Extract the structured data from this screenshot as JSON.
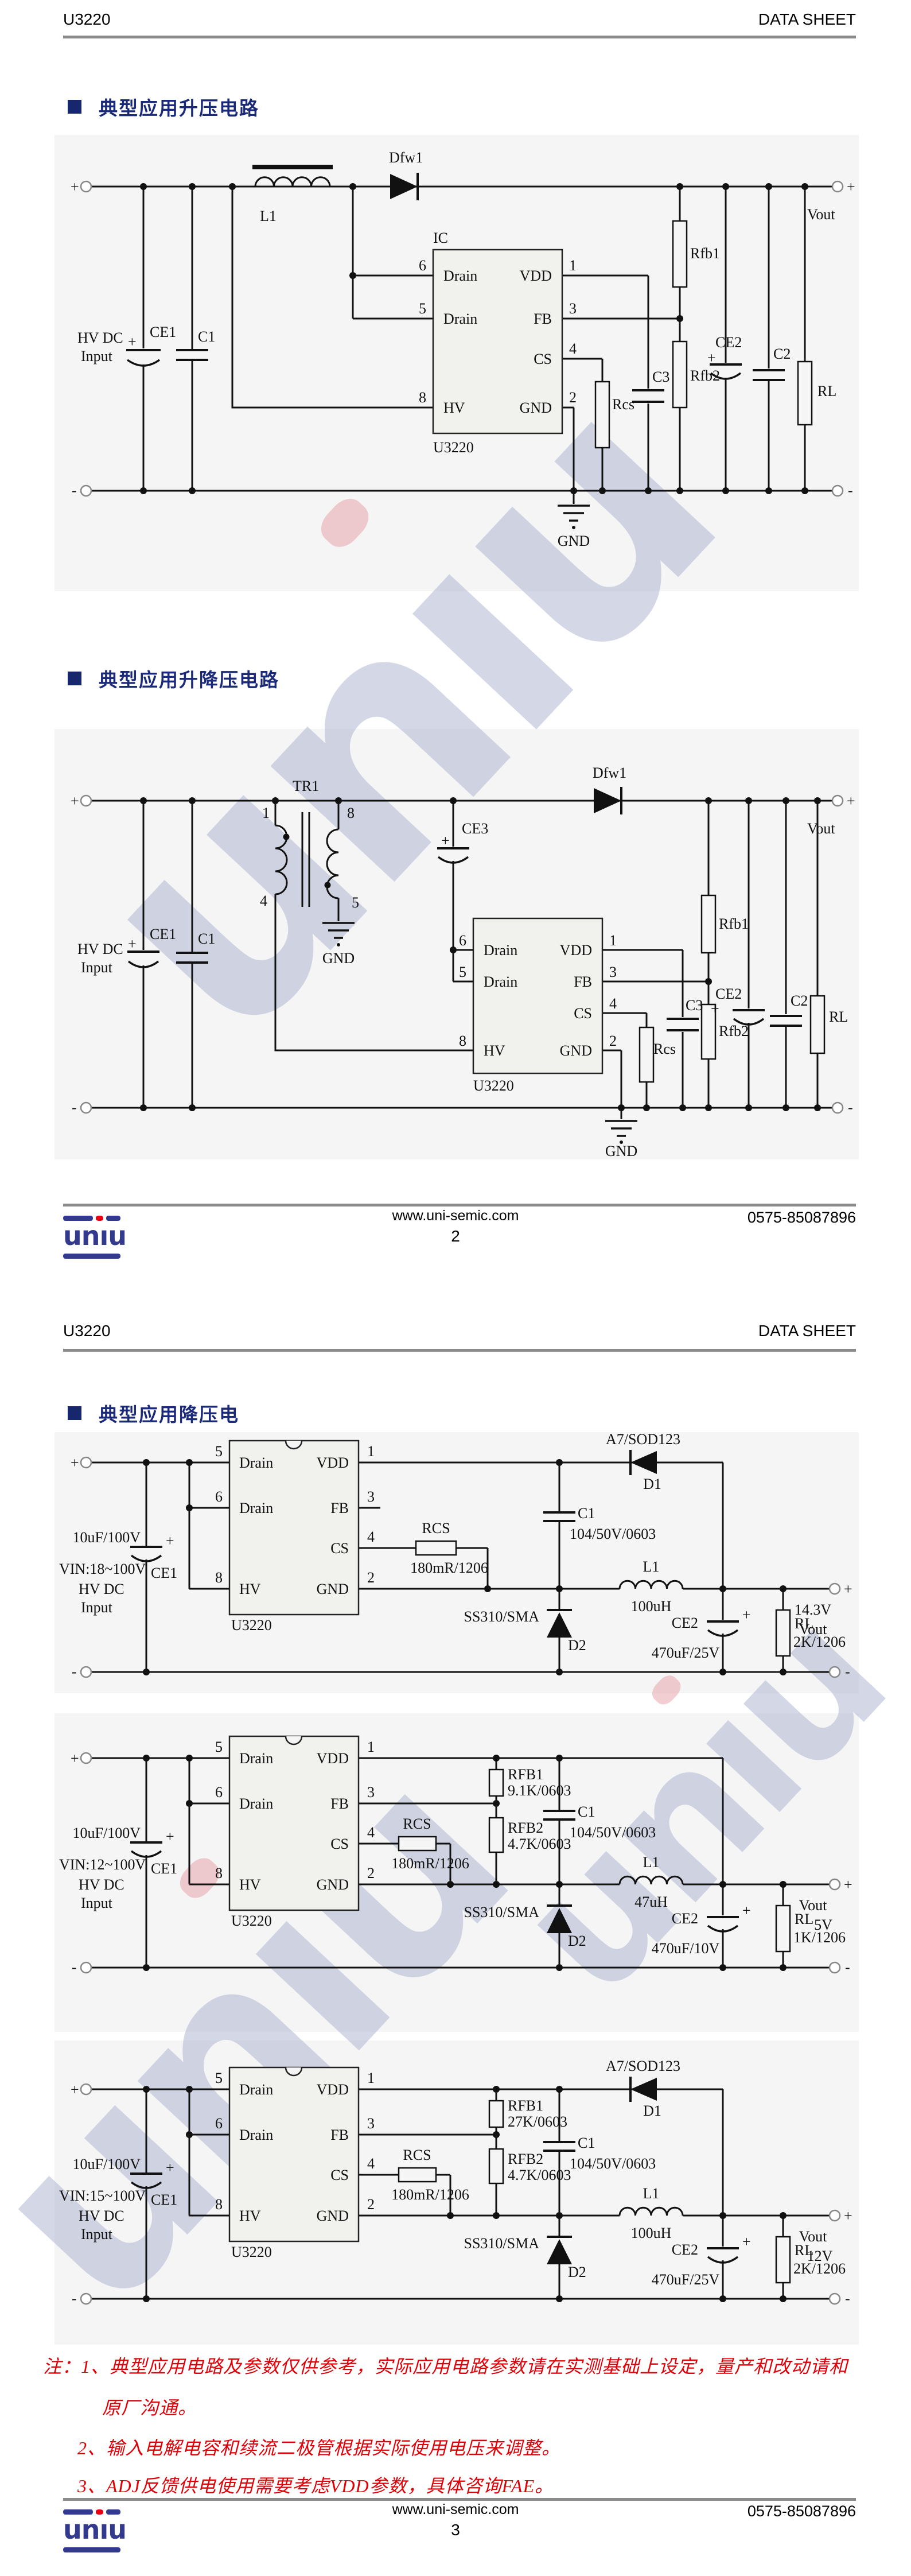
{
  "header": {
    "product": "U3220",
    "doc": "DATA SHEET"
  },
  "sections": {
    "s1": "典型应用升压电路",
    "s2": "典型应用升降压电路",
    "s3": "典型应用降压电"
  },
  "footer": {
    "site": "www.uni-semic.com",
    "phone": "0575-85087896",
    "p2": "2",
    "p3": "3"
  },
  "logo": {
    "l1": "un",
    "l2": "ı",
    "l3": "u"
  },
  "watermark": {
    "l1": "un",
    "l2": "ı",
    "l3": "u"
  },
  "notes": {
    "n1": "注：1、典型应用电路及参数仅供参考，实际应用电路参数请在实测基础上设定，量产和改动请和",
    "n2": "原厂沟通。",
    "n3": "2、输入电解电容和续流二极管根据实际使用电压来调整。",
    "n4": "3、ADJ反馈供电使用需要考虑VDD参数，具体咨询FAE。"
  },
  "sym": {
    "plus": "+",
    "minus": "-"
  },
  "pins": {
    "drain": "Drain",
    "vdd": "VDD",
    "fb": "FB",
    "cs": "CS",
    "gnd": "GND",
    "hv": "HV",
    "n1": "1",
    "n2": "2",
    "n3": "3",
    "n4": "4",
    "n5": "5",
    "n6": "6",
    "n8": "8"
  },
  "boost": {
    "hvdc": "HV DC",
    "input": "Input",
    "ce1": "CE1",
    "c1": "C1",
    "l1": "L1",
    "dfw1": "Dfw1",
    "ic": "IC",
    "part": "U3220",
    "rcs": "Rcs",
    "c3": "C3",
    "rfb1": "Rfb1",
    "rfb2": "Rfb2",
    "ce2": "CE2",
    "c2": "C2",
    "rl": "RL",
    "vout": "Vout",
    "gnd": "GND"
  },
  "buckboost": {
    "tr1": "TR1",
    "hvdc": "HV DC",
    "input": "Input",
    "ce1": "CE1",
    "c1": "C1",
    "ce3": "CE3",
    "dfw1": "Dfw1",
    "gnd_tr": "GND",
    "part": "U3220",
    "rcs": "Rcs",
    "c3": "C3",
    "rfb1": "Rfb1",
    "rfb2": "Rfb2",
    "ce2": "CE2",
    "c2": "C2",
    "rl": "RL",
    "vout": "Vout",
    "gnd": "GND"
  },
  "buck1": {
    "vin": "VIN:18~100V",
    "hvdc": "HV DC",
    "input": "Input",
    "ce1": "CE1",
    "ce1_val": "10uF/100V",
    "part": "U3220",
    "rcs": "RCS",
    "rcs_val": "180mR/1206",
    "c1": "C1",
    "c1_val": "104/50V/0603",
    "d1_type": "A7/SOD123",
    "d1": "D1",
    "l1": "L1",
    "l1_val": "100uH",
    "d2_type": "SS310/SMA",
    "d2": "D2",
    "ce2": "CE2",
    "ce2_val": "470uF/25V",
    "rl": "RL",
    "rl_val": "2K/1206",
    "vline1": "14.3V",
    "vline2": "Vout"
  },
  "buck2": {
    "vin": "VIN:12~100V",
    "hvdc": "HV DC",
    "input": "Input",
    "ce1": "CE1",
    "ce1_val": "10uF/100V",
    "part": "U3220",
    "rcs": "RCS",
    "rcs_val": "180mR/1206",
    "rfb1": "RFB1",
    "rfb1_val": "9.1K/0603",
    "rfb2": "RFB2",
    "rfb2_val": "4.7K/0603",
    "c1": "C1",
    "c1_val": "104/50V/0603",
    "l1": "L1",
    "l1_val": "47uH",
    "d2_type": "SS310/SMA",
    "d2": "D2",
    "ce2": "CE2",
    "ce2_val": "470uF/10V",
    "rl": "RL",
    "rl_val": "1K/1206",
    "vline1": "Vout",
    "vline2": "5V"
  },
  "buck3": {
    "vin": "VIN:15~100V",
    "hvdc": "HV DC",
    "input": "Input",
    "ce1": "CE1",
    "ce1_val": "10uF/100V",
    "part": "U3220",
    "rcs": "RCS",
    "rcs_val": "180mR/1206",
    "rfb1": "RFB1",
    "rfb1_val": "27K/0603",
    "rfb2": "RFB2",
    "rfb2_val": "4.7K/0603",
    "c1": "C1",
    "c1_val": "104/50V/0603",
    "d1_type": "A7/SOD123",
    "d1": "D1",
    "l1": "L1",
    "l1_val": "100uH",
    "d2_type": "SS310/SMA",
    "d2": "D2",
    "ce2": "CE2",
    "ce2_val": "470uF/25V",
    "rl": "RL",
    "rl_val": "2K/1206",
    "vline1": "Vout",
    "vline2": "12V"
  }
}
